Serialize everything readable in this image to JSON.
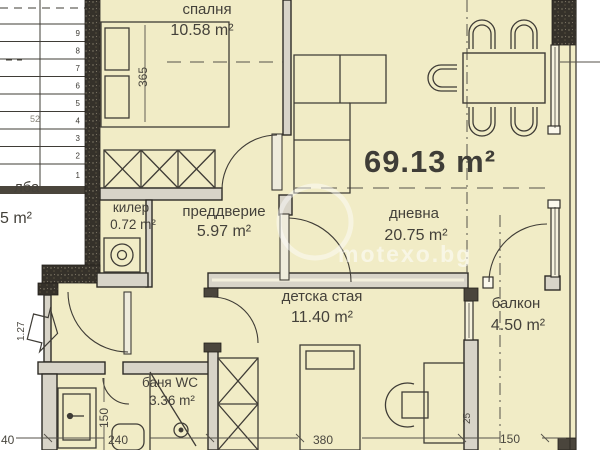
{
  "plan": {
    "total_area": "69.13 m²",
    "watermark": "motexo.bg",
    "rooms": {
      "bedroom": {
        "name": "спалня",
        "area": "10.58 m²"
      },
      "closet": {
        "name": "килер",
        "area": "0.72 m²"
      },
      "vestibule": {
        "name": "преддверие",
        "area": "5.97 m²"
      },
      "living": {
        "name": "дневна",
        "area": "20.75 m²"
      },
      "kids": {
        "name": "детска стая",
        "area": "11.40 m²"
      },
      "bath": {
        "name": "баня WC",
        "area": "3.36 m²"
      },
      "balcony": {
        "name": "балкон",
        "area": "4.50 m²"
      },
      "stairs": {
        "name": "лба",
        "area": "5 m²"
      }
    },
    "dimensions": {
      "d365": "365",
      "d240": "240",
      "d40": "40",
      "d380": "380",
      "d150_bottom": "150",
      "d150_bath": "150",
      "d25": "25",
      "d127": "1.27",
      "d52": "52"
    },
    "stair_steps": [
      "9",
      "8",
      "7",
      "6",
      "5",
      "4",
      "3",
      "2",
      "1"
    ],
    "colors": {
      "floor": "#f1ecc6",
      "wall_dark": "#35312a",
      "wall_light": "#d8d4c8",
      "line": "#3f3c36"
    }
  }
}
